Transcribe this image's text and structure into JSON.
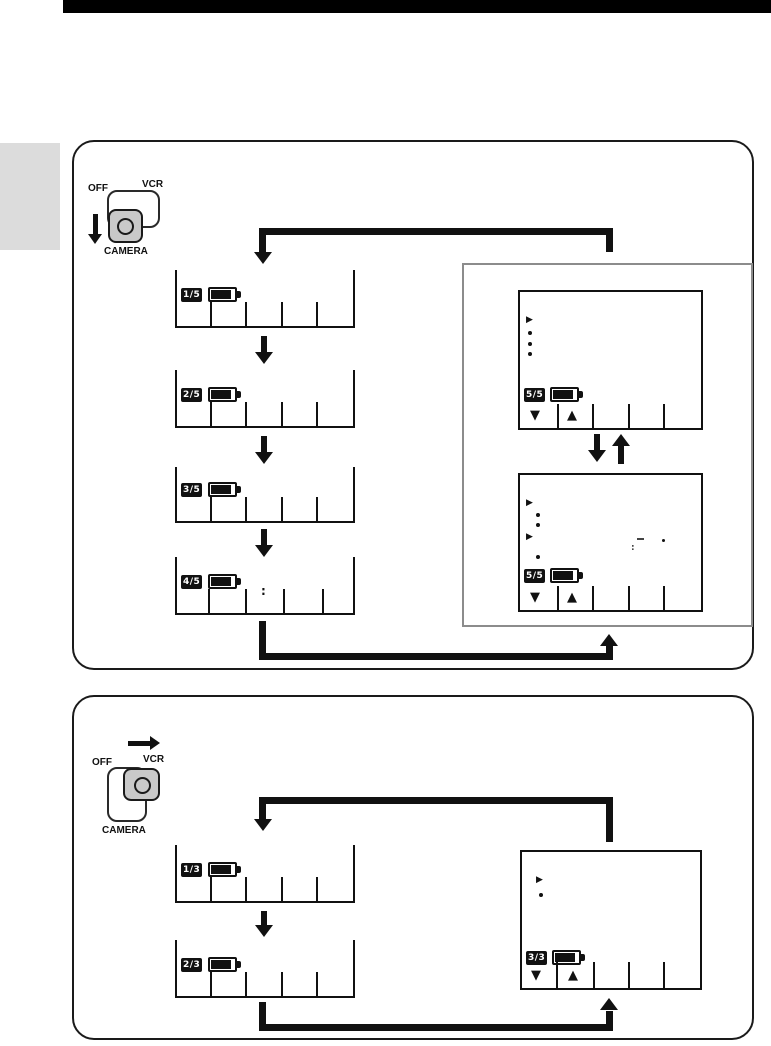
{
  "icons": {
    "menu_cursor": "▶",
    "bullet": "•",
    "down_triangle": "▼",
    "up_triangle": "▲"
  },
  "panel_camera": {
    "switch": {
      "off_label": "OFF",
      "vcr_label": "VCR",
      "camera_label": "CAMERA"
    },
    "status_screens": [
      {
        "page_badge": "1/5",
        "tick_count": 4
      },
      {
        "page_badge": "2/5",
        "tick_count": 4
      },
      {
        "page_badge": "3/5",
        "tick_count": 4
      },
      {
        "page_badge": "4/5",
        "tick_count": 4,
        "clock_colon": ":"
      }
    ],
    "menu_screens": {
      "upper": {
        "page_badge": "5/5"
      },
      "lower": {
        "page_badge": "5/5",
        "marks": {
          "dash": "-",
          "dot": ".",
          "colon": ":"
        }
      }
    }
  },
  "panel_vcr": {
    "switch": {
      "off_label": "OFF",
      "vcr_label": "VCR",
      "camera_label": "CAMERA"
    },
    "status_screens": [
      {
        "page_badge": "1/3",
        "tick_count": 4
      },
      {
        "page_badge": "2/3",
        "tick_count": 4
      }
    ],
    "menu_screen": {
      "page_badge": "3/3"
    }
  }
}
